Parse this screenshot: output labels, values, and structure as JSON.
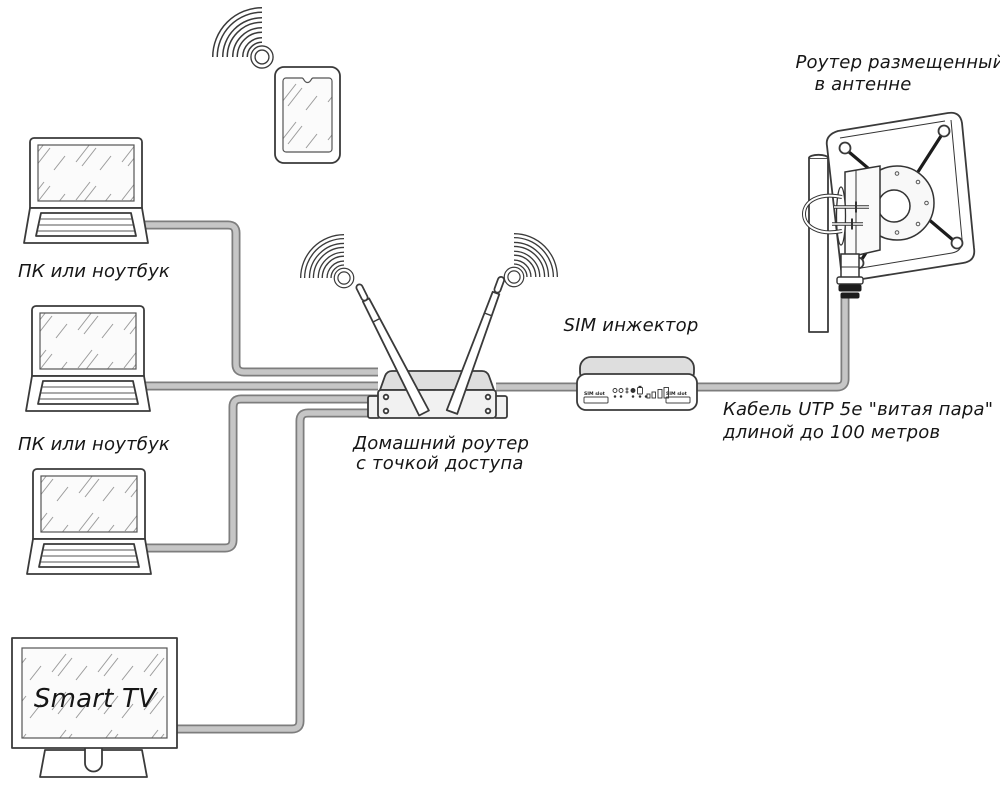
{
  "diagram": {
    "labels": {
      "pc_top": "ПК или ноутбук",
      "pc_middle": "ПК или ноутбук",
      "smart_tv": "Smart TV",
      "home_router_line1": "Домашний роутер",
      "home_router_line2": "с точкой доступа",
      "sim_injector": "SIM инжектор",
      "antenna_router_line1": "Роутер размещенный",
      "antenna_router_line2": "в антенне",
      "cable_line1": "Кабель UTP 5e \"витая пара\"",
      "cable_line2": "длиной до 100 метров"
    },
    "sim_injector_device": {
      "sim_slot_left": "SIM slot",
      "sim_slot_right": "SIM slot"
    },
    "icons": {
      "wifi_top": "wifi-signal-icon",
      "wifi_left": "wifi-signal-icon",
      "wifi_right": "wifi-signal-icon"
    },
    "colors": {
      "line": "#3a3a3a",
      "cable_outer": "#7d7d7d",
      "cable_inner": "#c6c6c6",
      "router_lid": "#dedede",
      "background": "#ffffff"
    }
  }
}
